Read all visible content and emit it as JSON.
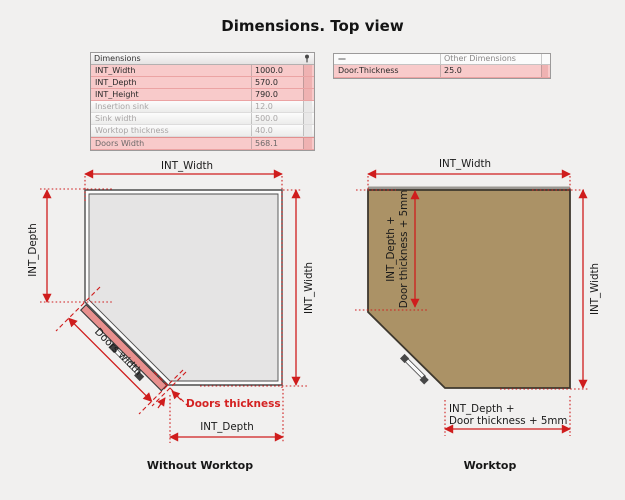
{
  "title": "Dimensions. Top view",
  "left_table": {
    "header": "Dimensions",
    "rows": [
      {
        "name": "INT_Width",
        "value": "1000.0"
      },
      {
        "name": "INT_Depth",
        "value": "570.0"
      },
      {
        "name": "INT_Height",
        "value": "790.0"
      },
      {
        "name": "Insertion sink",
        "value": "12.0"
      },
      {
        "name": "Sink width",
        "value": "500.0"
      },
      {
        "name": "Worktop thickness",
        "value": "40.0"
      },
      {
        "name": "Doors Width",
        "value": "568.1"
      }
    ]
  },
  "right_table": {
    "header_left": "—",
    "header_right": "Other Dimensions",
    "rows": [
      {
        "name": "Door.Thickness",
        "value": "25.0"
      }
    ]
  },
  "left_diagram": {
    "caption": "Without Worktop",
    "labels": {
      "top": "INT_Width",
      "left": "INT_Depth",
      "right": "INT_Width",
      "bottom": "INT_Depth",
      "door_width": "Doors width",
      "door_thickness": "Doors thickness"
    }
  },
  "right_diagram": {
    "caption": "Worktop",
    "labels": {
      "top": "INT_Width",
      "right": "INT_Width",
      "inner_line1": "INT_Depth +",
      "inner_line2": "Door thickness + 5mm",
      "bottom_line1": "INT_Depth +",
      "bottom_line2": "Door thickness + 5mm"
    }
  },
  "colors": {
    "dimension_red": "#cf1d1d",
    "worktop_fill": "#ab9266",
    "cabinet_fill": "#e5e4e4",
    "door_fill": "#e8908e",
    "row_highlight_pink": "#f8caca",
    "background": "#f1f0ef"
  }
}
